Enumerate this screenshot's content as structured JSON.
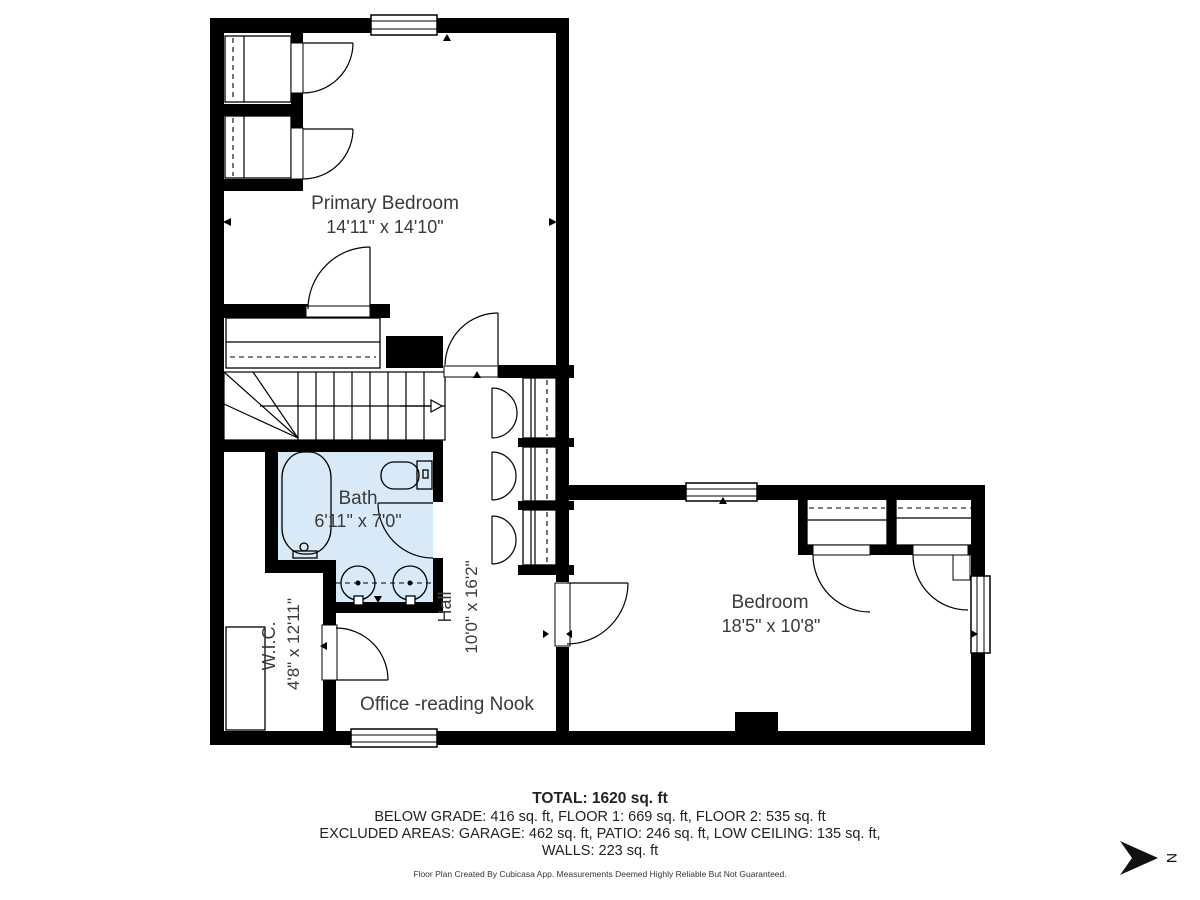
{
  "floor_plan": {
    "rooms": [
      {
        "id": "primary-bedroom",
        "name": "Primary Bedroom",
        "dimensions": "14'11\" x 14'10\""
      },
      {
        "id": "bath",
        "name": "Bath",
        "dimensions": "6'11\" x 7'0\""
      },
      {
        "id": "hall",
        "name": "Hall",
        "dimensions": "10'0\" x 16'2\""
      },
      {
        "id": "wic",
        "name": "W.I.C.",
        "dimensions": "4'8\" x 12'11\""
      },
      {
        "id": "office",
        "name": "Office -reading Nook",
        "dimensions": ""
      },
      {
        "id": "bedroom",
        "name": "Bedroom",
        "dimensions": "18'5\" x 10'8\""
      }
    ],
    "compass": {
      "label": "N"
    },
    "colors": {
      "wall": "#000000",
      "bath_fill": "#d8eaf7",
      "label_text": "#3a3a3a"
    }
  },
  "summary": {
    "total": "TOTAL: 1620 sq. ft",
    "below_grade_line": "BELOW GRADE: 416 sq. ft, FLOOR 1: 669 sq. ft, FLOOR 2: 535 sq. ft",
    "excluded_line": "EXCLUDED AREAS: GARAGE: 462 sq. ft, PATIO: 246 sq. ft, LOW CEILING: 135 sq. ft,",
    "walls_line": "WALLS: 223 sq. ft",
    "disclaimer": "Floor Plan Created By Cubicasa App. Measurements Deemed Highly Reliable But Not Guaranteed."
  }
}
